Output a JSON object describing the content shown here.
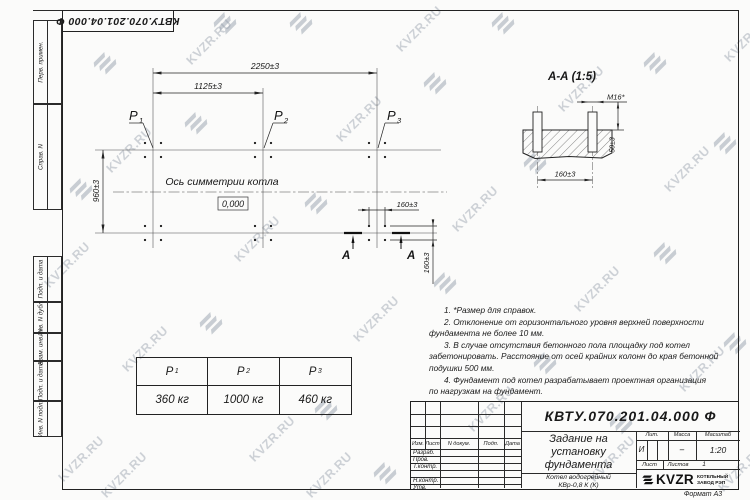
{
  "watermark": {
    "text": "KVZR.RU"
  },
  "stamp_top": {
    "text": "КВТУ.070.201.04.000 Ф"
  },
  "side_strip": {
    "top": [
      "Перв. примен.",
      "Справ. N"
    ],
    "bottom": [
      "Подп. и дата",
      "Инв. N дубл.",
      "Взам. инв. N",
      "Подп. и дата",
      "Инв. N подл."
    ]
  },
  "plan": {
    "dim_2250": "2250±3",
    "dim_1125": "1125±3",
    "dim_960": "960±3",
    "dim_160_h": "160±3",
    "dim_160_v": "160±3",
    "p1": {
      "base": "Р",
      "sub": "1"
    },
    "p2": {
      "base": "Р",
      "sub": "2"
    },
    "p3": {
      "base": "Р",
      "sub": "3"
    },
    "axis_label": "Ось симметрии котла",
    "level_mark": "0,000",
    "cut_label_left": "А",
    "cut_label_right": "А"
  },
  "section": {
    "title": "А-А (1:5)",
    "dim_thread": "М16*",
    "dim_50": "50±3",
    "dim_160": "160±3"
  },
  "notes": {
    "lines": [
      "1. *Размер для справок.",
      "2. Отклонение от горизонтального уровня верхней поверхности",
      "фундамента не более 10 мм.",
      "3. В случае отсутствия бетонного пола площадку под котел",
      "забетонировать. Расстояние от осей крайних колонн до края бетонной",
      "подушки 500 мм.",
      "4. Фундамент под котел разрабатывает проектная организация",
      "по нагрузкам на фундамент."
    ]
  },
  "load_table": {
    "headers": [
      {
        "base": "Р",
        "sub": "1"
      },
      {
        "base": "Р",
        "sub": "2"
      },
      {
        "base": "Р",
        "sub": "3"
      }
    ],
    "values": [
      "360 кг",
      "1000 кг",
      "460 кг"
    ]
  },
  "title_block": {
    "doc_number": "КВТУ.070.201.04.000 Ф",
    "title_lines": [
      "Задание на",
      "установку",
      "фундамента"
    ],
    "product_lines": [
      "Котел водогрейный",
      "КВр-0,8 К (К)"
    ],
    "header_cols": [
      "Изм.",
      "Лист",
      "N докум.",
      "Подп.",
      "Дата"
    ],
    "row_labels": [
      "Разраб.",
      "Пров.",
      "Т.контр.",
      "",
      "Н.контр.",
      "Утв."
    ],
    "lit_header": "Лит.",
    "mass_header": "Масса",
    "scale_header": "Масштаб",
    "lit_value": "И",
    "mass_value": "–",
    "scale_value": "1:20",
    "sheet_label": "Лист",
    "sheets_label": "Листов",
    "sheets_value": "1",
    "logo_text": "KVZR",
    "company_line1": "КОТЕЛЬНЫЙ",
    "company_line2": "ЗАВОД РЭП",
    "format_label": "Формат А3"
  }
}
